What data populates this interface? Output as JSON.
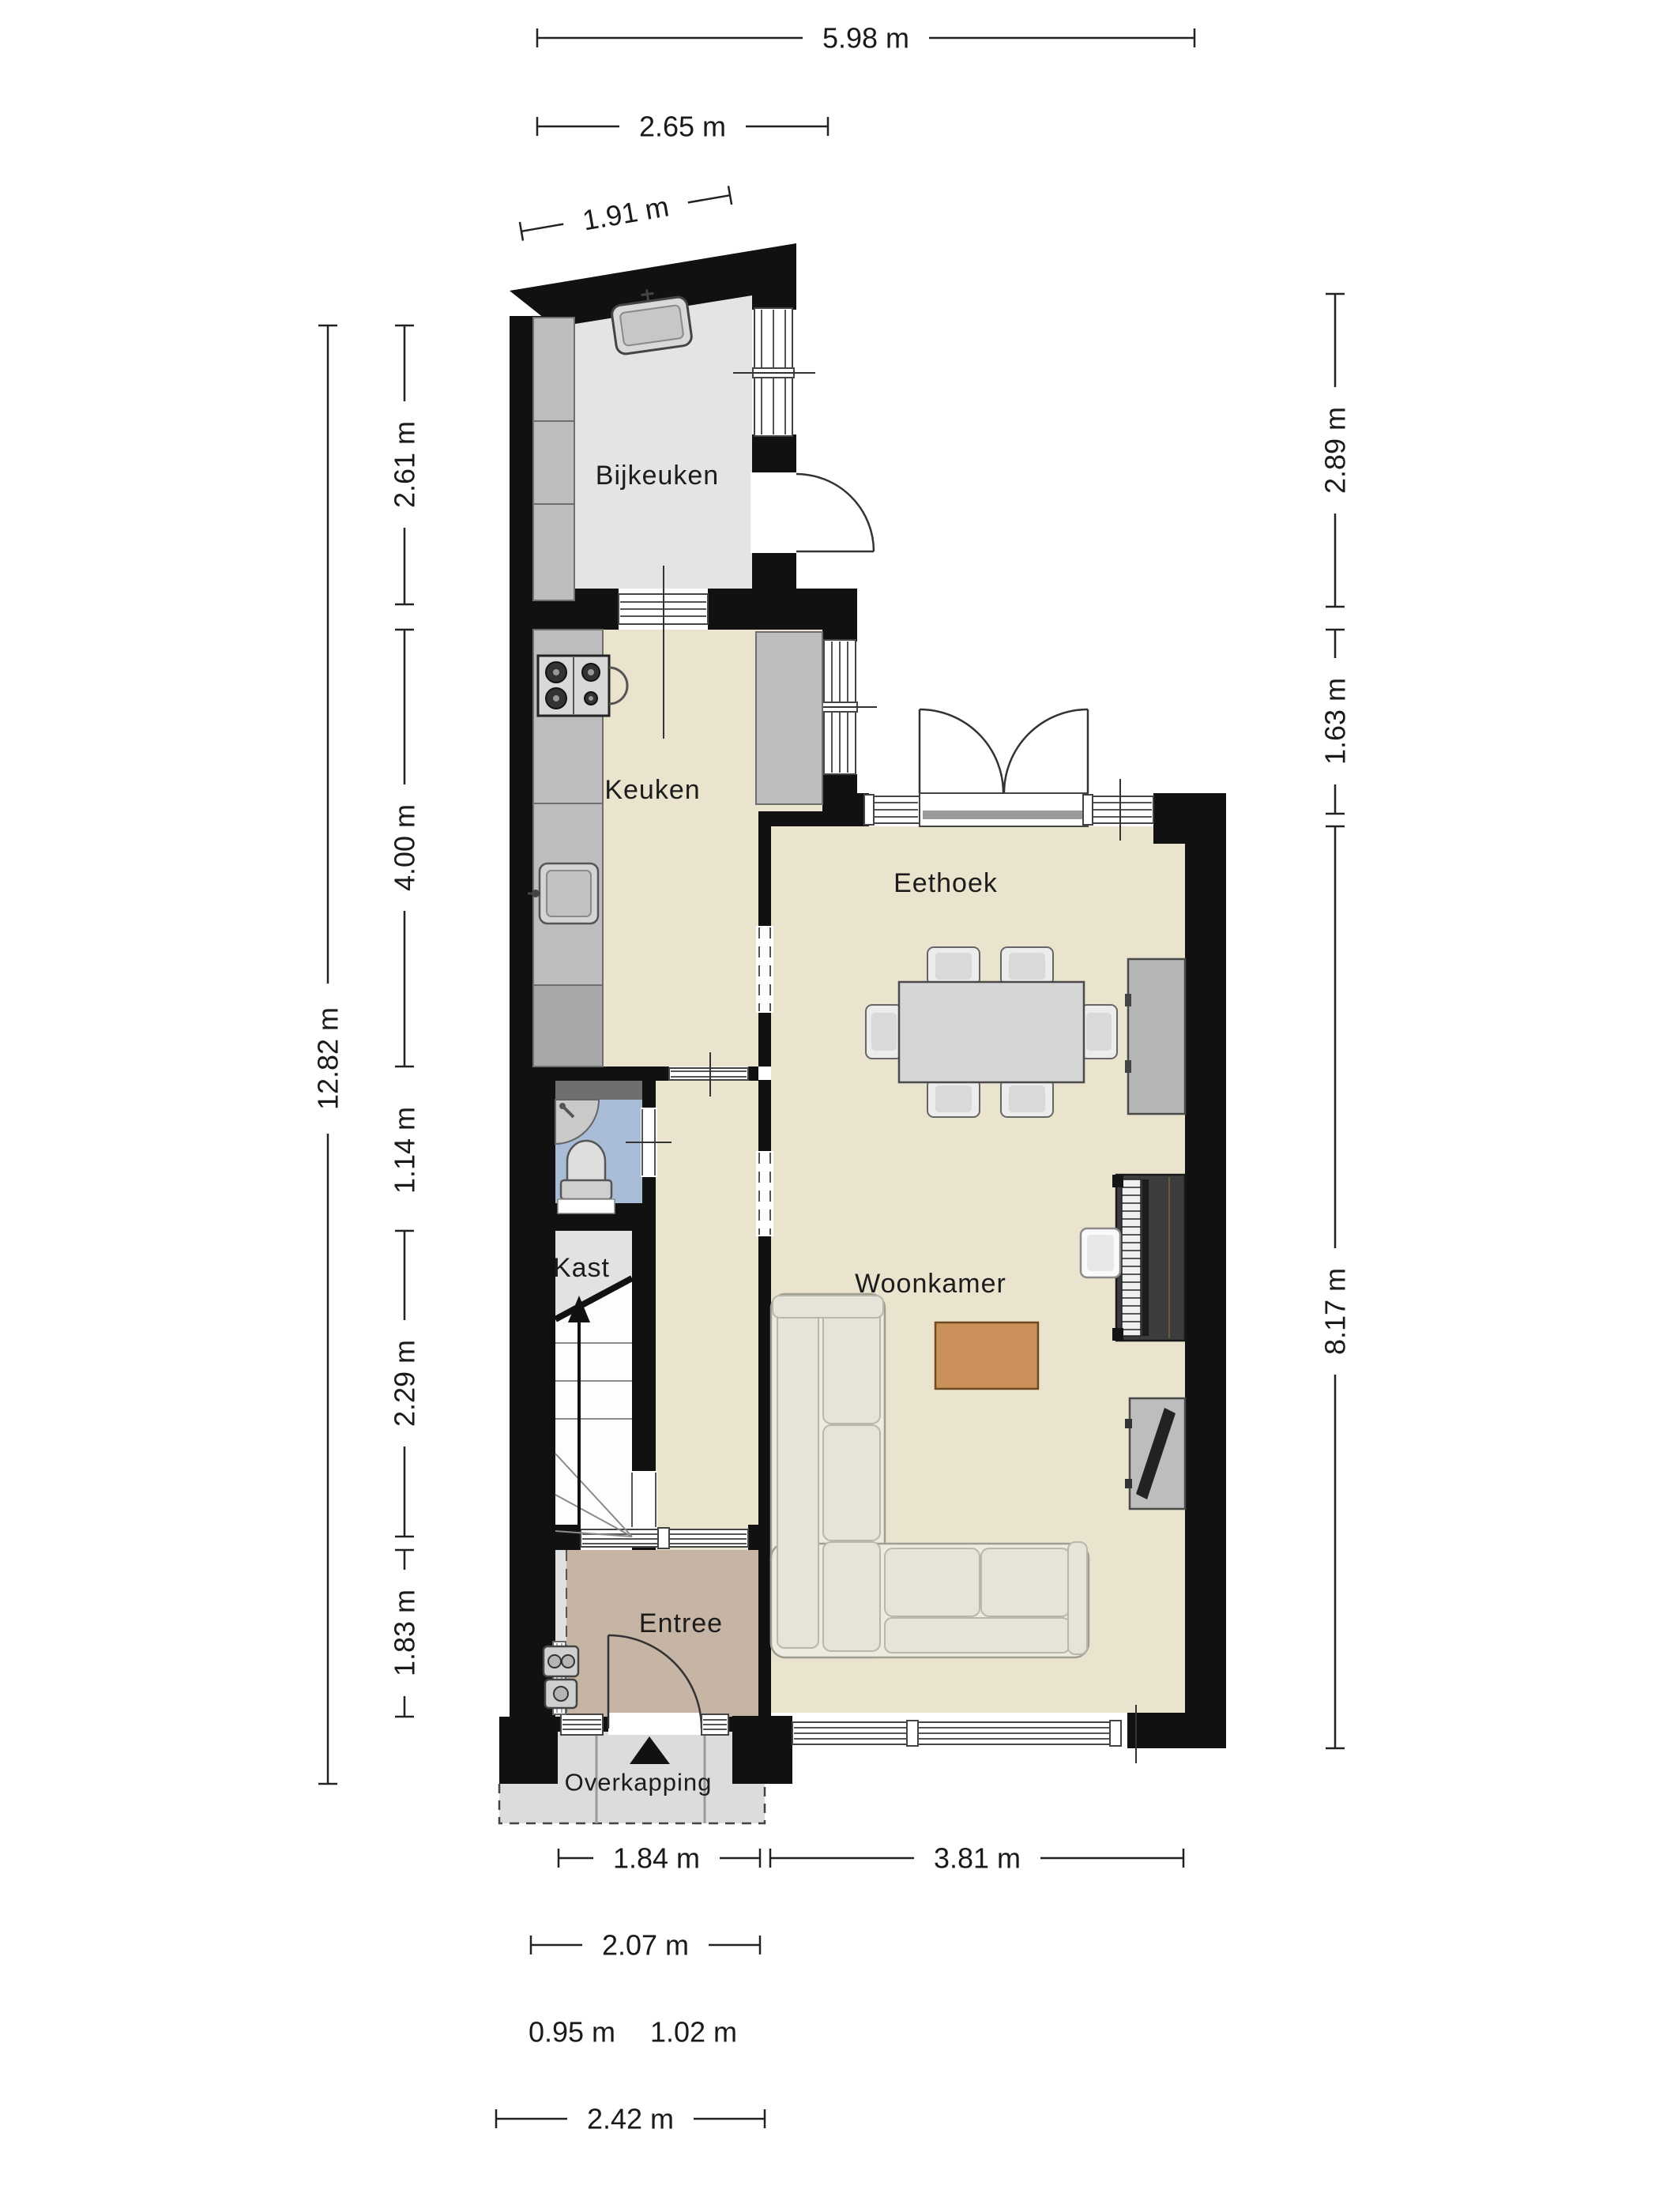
{
  "plan": {
    "type": "floorplan",
    "floor": "ground-floor",
    "language": "nl"
  },
  "rooms": {
    "bijkeuken": {
      "label": "Bijkeuken"
    },
    "keuken": {
      "label": "Keuken"
    },
    "eethoek": {
      "label": "Eethoek"
    },
    "woonkamer": {
      "label": "Woonkamer"
    },
    "kast": {
      "label": "Kast"
    },
    "entree": {
      "label": "Entree"
    },
    "overkapping": {
      "label": "Overkapping"
    }
  },
  "dimensions": {
    "top": [
      {
        "label": "5.98 m"
      },
      {
        "label": "2.65 m"
      },
      {
        "label": "1.91 m"
      }
    ],
    "left": [
      {
        "label": "2.61 m"
      },
      {
        "label": "4.00 m"
      },
      {
        "label": "12.82 m"
      },
      {
        "label": "1.14 m"
      },
      {
        "label": "2.29 m"
      },
      {
        "label": "1.83 m"
      }
    ],
    "right": [
      {
        "label": "2.89 m"
      },
      {
        "label": "1.63 m"
      },
      {
        "label": "8.17 m"
      }
    ],
    "bottom": [
      {
        "label": "1.84 m"
      },
      {
        "label": "3.81 m"
      },
      {
        "label": "2.07 m"
      },
      {
        "label": "0.95 m"
      },
      {
        "label": "1.02 m"
      },
      {
        "label": "2.42 m"
      }
    ]
  },
  "colors": {
    "wall": "#111111",
    "floor_living": "#eae3cd",
    "floor_utility": "#e4e4e4",
    "floor_wc": "#a9bdd9",
    "floor_entry": "#c6b4a4",
    "floor_canopy": "#dcdcdc",
    "counter": "#bdbdbd",
    "table_wood": "#c9905a"
  }
}
